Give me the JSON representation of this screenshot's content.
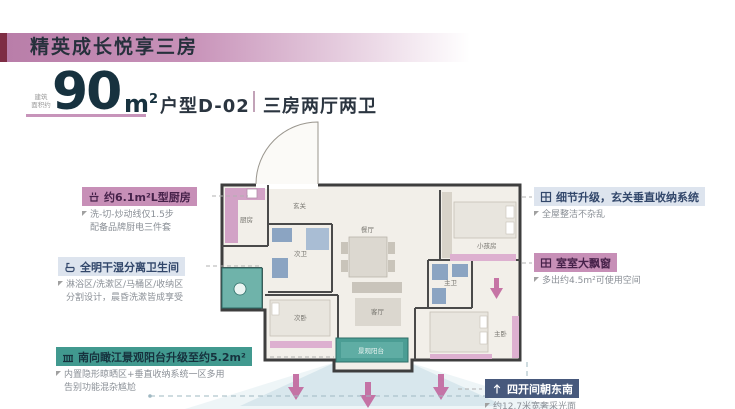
{
  "banner": {
    "title": "精英成长悦享三房"
  },
  "area": {
    "stamp_line1": "建筑",
    "stamp_line2": "面积约",
    "value": "90",
    "unit": "m",
    "unit_sup": "2",
    "type": "户型D-02",
    "layout": "三房两厅两卫"
  },
  "callouts": {
    "kitchen": {
      "title": "约6.1m²L型厨房",
      "lines": [
        "洗-切-炒动线仅1.5步",
        "配备品牌厨电三件套"
      ]
    },
    "bathroom": {
      "title": "全明干湿分离卫生间",
      "lines": [
        "淋浴区/洗漱区/马桶区/收纳区",
        "分割设计，晨昏洗漱皆成享受"
      ]
    },
    "balcony": {
      "title": "南向瞰江景观阳台升级至约5.2m²",
      "lines": [
        "内置隐形晾晒区+垂直收纳系统一区多用",
        "告别功能混杂尴尬"
      ]
    },
    "entry_storage": {
      "title": "细节升级，玄关垂直收纳系统",
      "lines": [
        "全屋整洁不杂乱"
      ]
    },
    "bay_window": {
      "title": "室室大飘窗",
      "lines": [
        "多出约4.5m²可使用空间"
      ]
    },
    "orientation": {
      "title": "四开间朝东南",
      "lines": [
        "约12.7米宽奢采光面"
      ]
    }
  },
  "floorplan": {
    "rooms": {
      "kitchen": "厨房",
      "hall": "玄关",
      "bath2": "次卫",
      "dining": "餐厅",
      "kids": "小孩房",
      "master_bath": "主卫",
      "master": "主卧",
      "bed2": "次卧",
      "living": "客厅",
      "view_balcony": "景观阳台"
    }
  },
  "colors": {
    "accent_pink": "#c78fb7",
    "accent_navy": "#47597c",
    "accent_teal": "#41998f",
    "banner_maroon": "#7e2d44",
    "headline_navy": "#17323f"
  }
}
